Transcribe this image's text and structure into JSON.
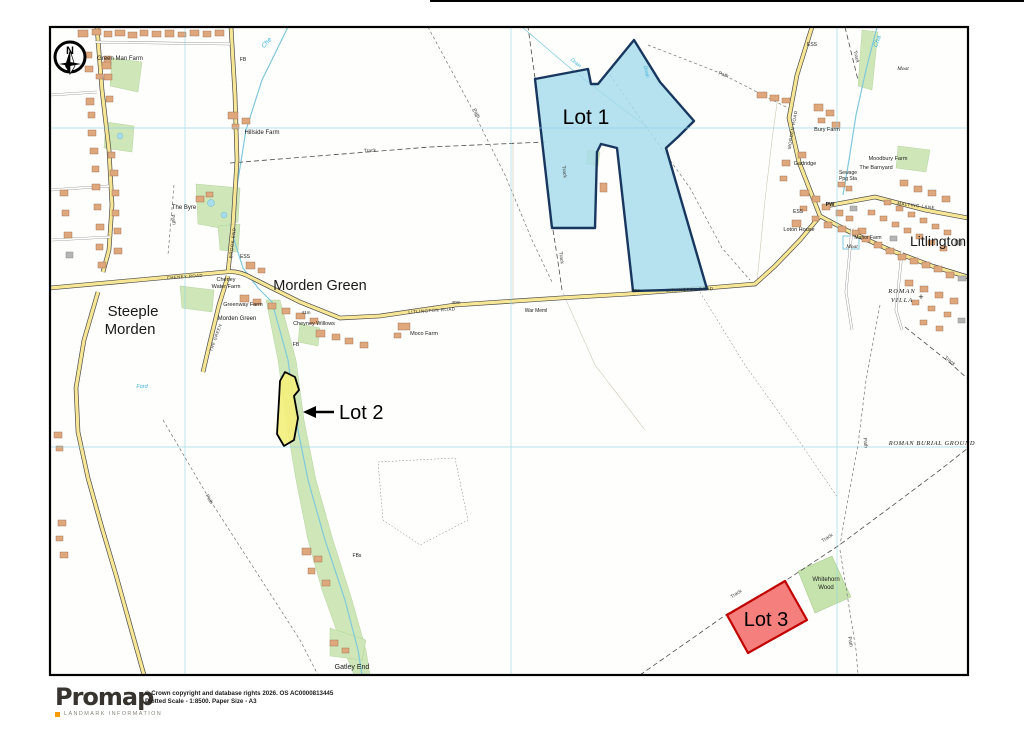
{
  "window": {
    "title": "Promap plotted map"
  },
  "compass": {
    "north": "N"
  },
  "lots": [
    {
      "label": "Lot 1",
      "fill": "#a9dcec",
      "stroke": "#17375e"
    },
    {
      "label": "Lot 2",
      "fill": "#f4ef7c",
      "stroke": "#000000"
    },
    {
      "label": "Lot 3",
      "fill": "#f4716e",
      "stroke": "#c00000"
    }
  ],
  "labels": {
    "steeple_line1": "Steeple",
    "steeple_line2": "Morden",
    "morden_green": "Morden Green",
    "litlington": "Litlington",
    "green_man_farm": "Green Man Farm",
    "hillside_farm": "Hillside Farm",
    "cheney_water_1": "Cheney",
    "cheney_water_2": "Water Farm",
    "greenway_farm": "Greenway Farm",
    "morden_green_small": "Morden Green",
    "cheyney_willows": "Cheyney Willows",
    "moco_farm": "Moco Farm",
    "the_byre": "The Byre",
    "bury_farm": "Bury Farm",
    "gadridge": "Gadridge",
    "moodbury_farm": "Moodbury Farm",
    "the_barnyard": "The Barnyard",
    "sewage_1": "Sewage",
    "sewage_2": "Ppg Sta",
    "loton_house": "Loton House",
    "manor_farm": "Manor Farm",
    "moat": "Moat",
    "whitehorn_1": "Whitehorn",
    "whitehorn_2": "Wood",
    "gatley_end": "Gatley End",
    "roman_villa_1": "ROMAN",
    "roman_villa_2": "VILLA",
    "roman_cross": "+",
    "roman_burial": "ROMAN BURIAL GROUND",
    "war_meml": "War Meml",
    "fb": "FB",
    "fbs": "FBs",
    "pw": "PW",
    "ess": "ESS",
    "track": "Track",
    "path": "Path",
    "ford": "Ford",
    "che": "Che",
    "cha": "Cha",
    "drain": "Drain",
    "litlington_road": "LITLINGTON ROAD",
    "brook_end": "BROOK END",
    "malting_lane": "MALTING LANE",
    "morden_road": "MORDEN ROAD",
    "the_green": "THE GREEN",
    "cheney_road": "CHENEY ROAD",
    "spot_41": "41m",
    "spot_40": "40m"
  },
  "footer": {
    "brand": "Promap",
    "brand_sub": "LANDMARK INFORMATION",
    "copyright_line1": "© Crown copyright and database rights 2026. OS AC0000813445",
    "copyright_line2": "Plotted Scale - 1:8500. Paper Size - A3"
  },
  "colors": {
    "grid": "#86d2e6",
    "road_fill": "#f7e794",
    "green": "#cfe7b8",
    "water": "#7fc8dc",
    "accent_orange": "#f59b00"
  }
}
